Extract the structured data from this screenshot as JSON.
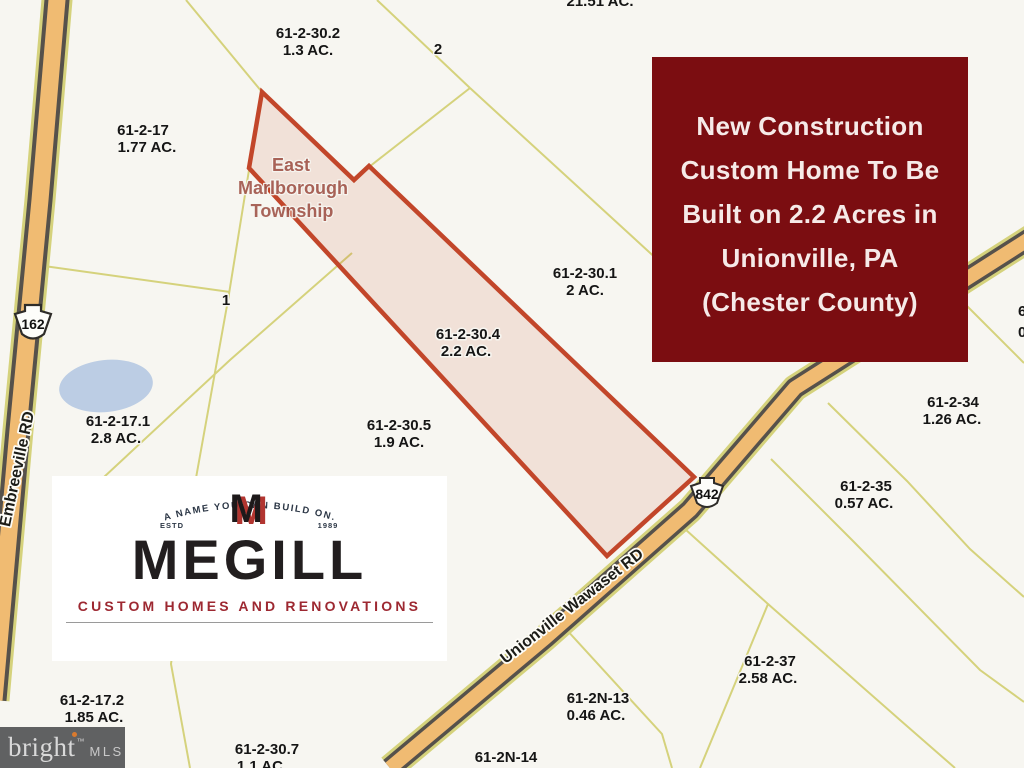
{
  "map": {
    "township": {
      "line1": "East",
      "line2": "Marlborough",
      "line3": "Township"
    },
    "parcels": [
      {
        "label": "61-2-30.2",
        "acreage": "1.3 AC."
      },
      {
        "label": "61-2-17",
        "acreage": "1.77 AC."
      },
      {
        "label": "61-2-30.1",
        "acreage": "2 AC."
      },
      {
        "label": "61-2-30.4",
        "acreage": "2.2 AC."
      },
      {
        "label": "61-2-17.1",
        "acreage": "2.8 AC."
      },
      {
        "label": "61-2-30.5",
        "acreage": "1.9 AC."
      },
      {
        "label": "61-2-34",
        "acreage": "1.26 AC."
      },
      {
        "label": "61-2-35",
        "acreage": "0.57 AC."
      },
      {
        "label": "61-2-37",
        "acreage": "2.58 AC."
      },
      {
        "label": "61-2N-13",
        "acreage": "0.46 AC."
      },
      {
        "label": "61-2-17.2",
        "acreage": "1.85 AC."
      },
      {
        "label": "61-2-30.7",
        "acreage": "1.1 AC."
      },
      {
        "label": "61-2N-14",
        "acreage": ""
      }
    ],
    "plain_numbers": {
      "n1": "1",
      "n2": "2"
    },
    "partial_top_label": "21.51 AC.",
    "right_edge_partial": {
      "line1": "6",
      "line2": "0"
    },
    "roads": {
      "embreeville": {
        "shield": "162",
        "label": "Embreeville RD"
      },
      "unionville": {
        "shield": "842",
        "label": "Unionville Wawaset RD"
      }
    },
    "colors": {
      "background": "#f7f6f1",
      "parcel_line": "#d5d27c",
      "highlight_stroke": "#c2462a",
      "highlight_fill": "#f5e7e2",
      "road_fill": "#f0bb72",
      "road_casing": "#56514b",
      "pond_fill": "#bccde4"
    }
  },
  "banner": {
    "lines": [
      "New Construction",
      "Custom Home To Be",
      "Built on 2.2 Acres in",
      "Unionville, PA",
      "(Chester County)"
    ],
    "bg_color": "#7b0d11",
    "text_color": "#f6eae8"
  },
  "megill": {
    "arc_text": "A NAME YOU CAN BUILD ON.",
    "estd": "ESTD",
    "year": "1989",
    "monogram": "M",
    "wordmark": "MEGILL",
    "tagline": "CUSTOM HOMES AND RENOVATIONS",
    "tagline_color": "#9d2831"
  },
  "watermark": {
    "brand": "bright",
    "tm": "™",
    "suffix": "MLS"
  }
}
